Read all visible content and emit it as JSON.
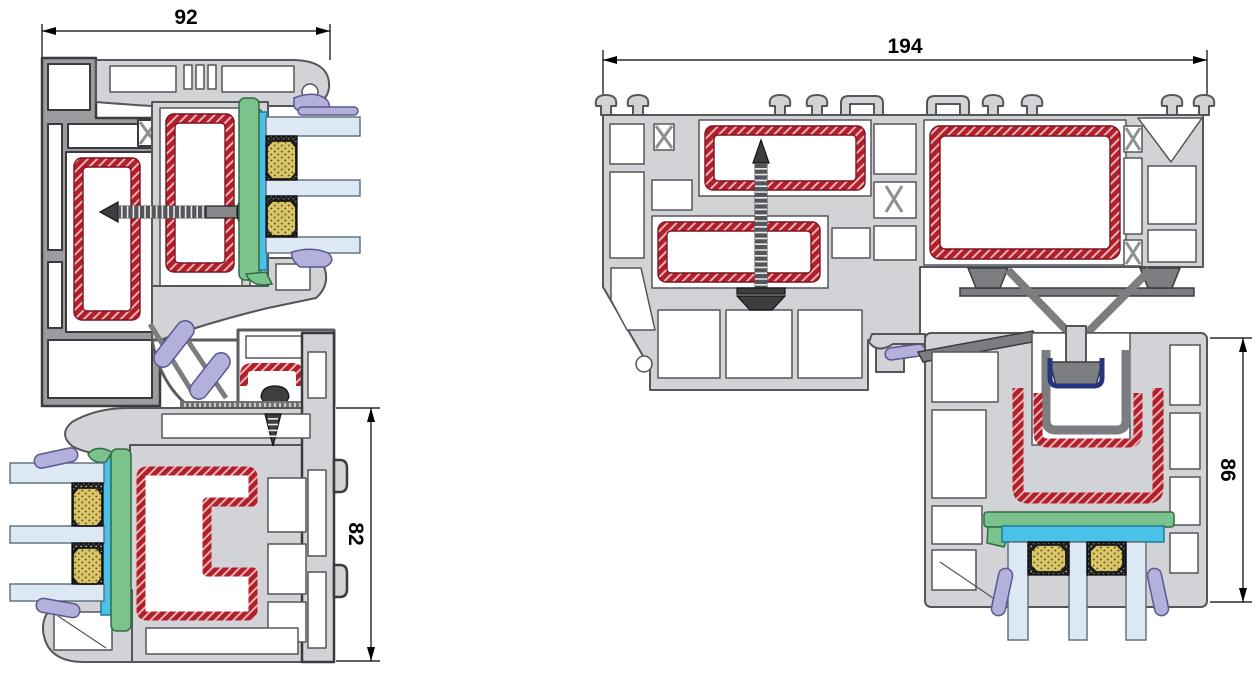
{
  "diagrams": {
    "left_section": {
      "width_dim": "92",
      "height_dim": "82"
    },
    "right_section": {
      "width_dim": "194",
      "height_dim": "86"
    }
  },
  "colors": {
    "background": "#ffffff",
    "profile": "#d2d3d6",
    "profile_outline": "#55565a",
    "profile_outline_dark": "#3a3b3e",
    "frame_gray": "#9a9c9f",
    "dark_metal": "#7b7d80",
    "steel_red": "#b11f2b",
    "steel_red_dark": "#7c1420",
    "gasket_green": "#7cc28c",
    "gasket_green_dark": "#2f6d41",
    "glazing_tape_cyan": "#49c1e8",
    "glazing_tape_dark": "#1b7c9b",
    "glass_blue": "#dce9f4",
    "glass_outline": "#5b6b77",
    "spacer_yellow": "#dac76b",
    "spacer_dot": "#6e5e17",
    "spacer_black": "#202020",
    "seal_lavender": "#b3b1dc",
    "seal_lavender_dark": "#5a5890",
    "clip_navy": "#27337e",
    "screw_gray": "#54565a",
    "dim_black": "#000000"
  }
}
